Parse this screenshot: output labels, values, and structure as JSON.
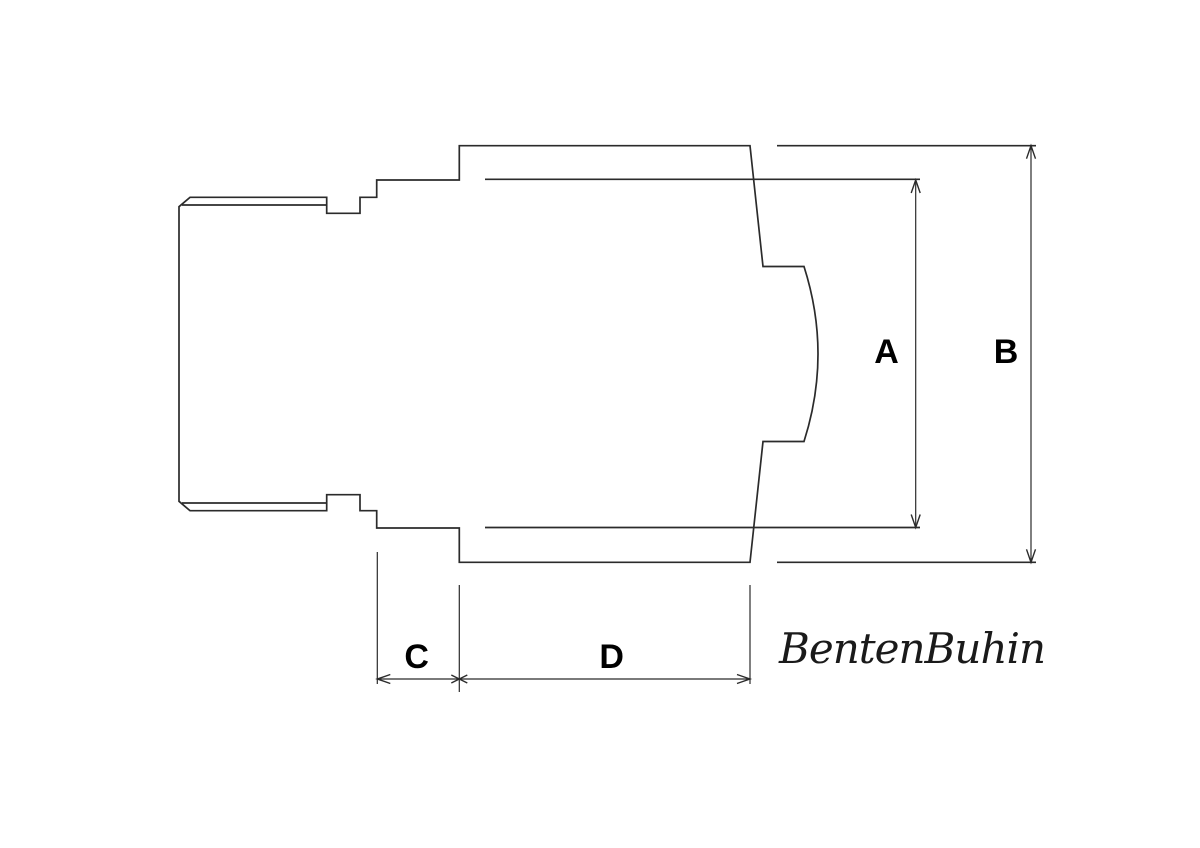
{
  "colors": {
    "background": "#ffffff",
    "outline": "#2b2b2b",
    "dimension_lines": "#2b2b2b",
    "label_text": "#000000"
  },
  "drawing": {
    "kind": "technical line drawing, side profile with stepped cylindrical part, curved right face",
    "dimensions": {
      "a": {
        "label": "A",
        "orientation": "vertical"
      },
      "b": {
        "label": "B",
        "orientation": "vertical"
      },
      "c": {
        "label": "C",
        "orientation": "horizontal"
      },
      "d": {
        "label": "D",
        "orientation": "horizontal"
      }
    },
    "watermark": {
      "text": "BentenBuhin"
    }
  }
}
